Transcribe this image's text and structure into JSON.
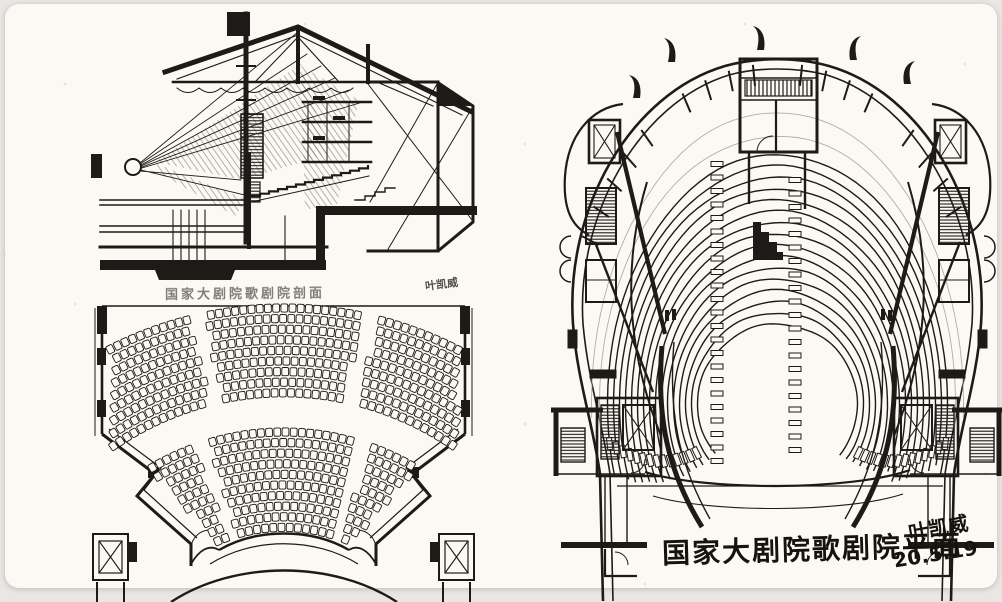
{
  "palette": {
    "ink": "#1d1b17",
    "pencil": "#a49c8e",
    "paper": "#fbf9f4",
    "frame_background": "#e8e7e4"
  },
  "sheet": {
    "section_drawing": {
      "caption": "国家大剧院歌剧院剖面",
      "signature": "叶凯威"
    },
    "plan_drawing": {
      "caption": "国家大剧院歌剧院平面",
      "signature": "叶凯威",
      "date": "20.5.19"
    }
  }
}
